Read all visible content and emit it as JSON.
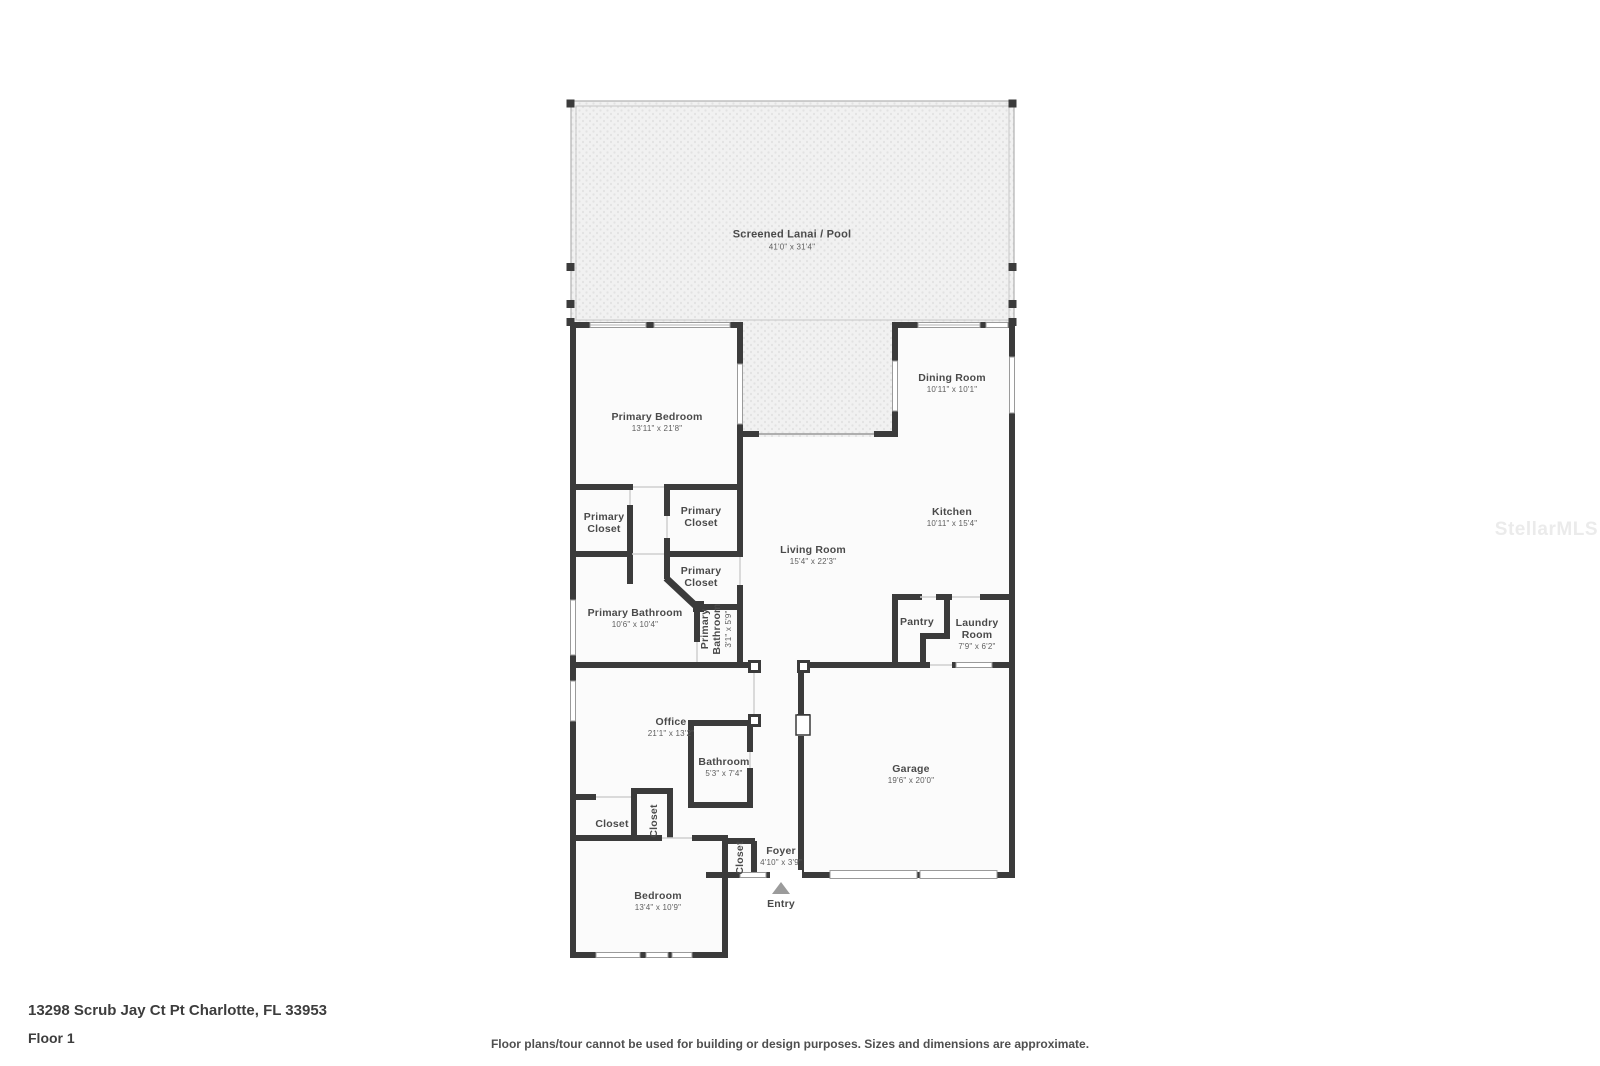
{
  "address": "13298 Scrub Jay Ct Pt Charlotte, FL 33953",
  "floor_label": "Floor 1",
  "disclaimer": "Floor plans/tour cannot be used for building or design purposes. Sizes and dimensions are approximate.",
  "watermark": "StellarMLS",
  "entry_label": "Entry",
  "colors": {
    "wall": "#3b3b3b",
    "room_fill": "#fbfbfb",
    "lanai_fill": "#f1f1f1",
    "label_text": "#4a4a4a"
  },
  "rooms": {
    "lanai": {
      "name": "Screened Lanai / Pool",
      "dims": "41'0\" x 31'4\""
    },
    "primary_bedroom": {
      "name": "Primary Bedroom",
      "dims": "13'11\" x 21'8\""
    },
    "dining_room": {
      "name": "Dining Room",
      "dims": "10'11\" x 10'1\""
    },
    "kitchen": {
      "name": "Kitchen",
      "dims": "10'11\" x 15'4\""
    },
    "living_room": {
      "name": "Living Room",
      "dims": "15'4\" x 22'3\""
    },
    "primary_closet_1": {
      "name": "Primary Closet"
    },
    "primary_closet_2": {
      "name": "Primary Closet"
    },
    "primary_closet_3": {
      "name": "Primary Closet"
    },
    "primary_bathroom": {
      "name": "Primary Bathroom",
      "dims": "10'6\" x 10'4\""
    },
    "primary_bathroom_wc": {
      "name": "Primary Bathroom",
      "dims": "3'1\" x 5'9\""
    },
    "pantry": {
      "name": "Pantry"
    },
    "laundry_room": {
      "name": "Laundry Room",
      "dims": "7'9\" x 6'2\""
    },
    "office": {
      "name": "Office",
      "dims": "21'1\" x 13'2\""
    },
    "bathroom": {
      "name": "Bathroom",
      "dims": "5'3\" x 7'4\""
    },
    "garage": {
      "name": "Garage",
      "dims": "19'6\" x 20'0\""
    },
    "closet_hall": {
      "name": "Closet"
    },
    "closet_hall_2": {
      "name": "Closet"
    },
    "closet_foyer": {
      "name": "Closet"
    },
    "foyer": {
      "name": "Foyer",
      "dims": "4'10\" x 3'9\""
    },
    "bedroom": {
      "name": "Bedroom",
      "dims": "13'4\" x 10'9\""
    }
  }
}
